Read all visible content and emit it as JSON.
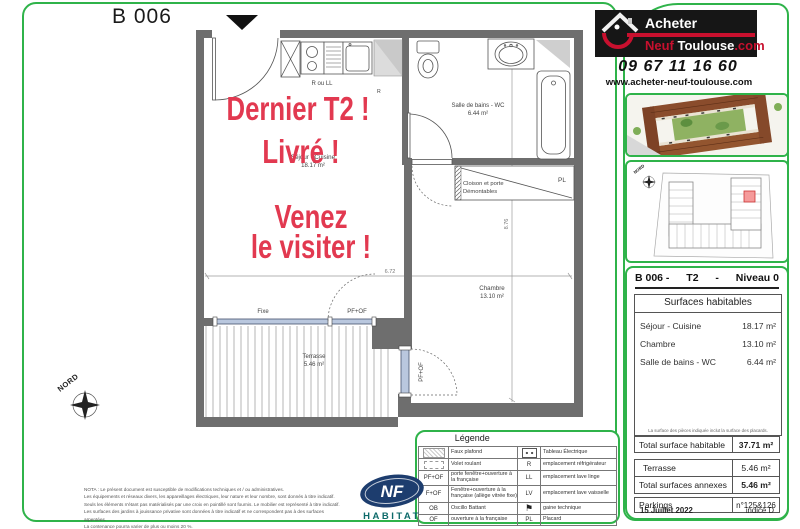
{
  "page": {
    "title": "B 006"
  },
  "plan": {
    "rooms": [
      {
        "name": "Séjour - Cuisine",
        "area": "18.17 m²"
      },
      {
        "name": "Salle de bains - WC",
        "area": "6.44 m²"
      },
      {
        "name": "Chambre",
        "area": "13.10 m²"
      },
      {
        "name": "Terrasse",
        "area": "5.46 m²"
      }
    ],
    "labels": {
      "r_ou_ll": "R ou LL",
      "r": "R",
      "fixe": "Fixe",
      "pf_of": "PF+OF",
      "pl": "PL",
      "cloison1": "Cloison et porte",
      "cloison2": "Démontables",
      "dim_width": "6.72",
      "dim_height": "8.76",
      "nord": "NORD"
    }
  },
  "promo": {
    "line1": "Dernier T2 !",
    "line2": "Livré !",
    "line3": "Venez",
    "line4": "le visiter !"
  },
  "nota": {
    "lines": [
      "NOTA : Le présent document est susceptible de modifications techniques et / ou administratives.",
      "Les équipements et réseaux divers, les appareillages électriques, leur nature et leur nombre, sont donnés à titre indicatif.",
      "Seuls les éléments n'étant pas matérialisés par une croix en pointillé sont fournis. Le mobilier est représenté à titre indicatif.",
      "Les surfaces des jardins à jouissance privative sont données à titre indicatif et ne correspondent pas à des surfaces arpentées.",
      "La contenance pourra varier de plus ou moins 20 %."
    ]
  },
  "certification": {
    "nf": "NF",
    "habitat": "HABITAT"
  },
  "legend": {
    "title": "Légende",
    "rows": [
      {
        "code": "",
        "label": "Faux plafond",
        "code2": "",
        "label2": "Tableau Électrique"
      },
      {
        "code": "",
        "label": "Volet roulant",
        "code2": "R",
        "label2": "emplacement réfrigérateur"
      },
      {
        "code": "PF+OF",
        "label": "porte fenêtre+ouverture à la française",
        "code2": "LL",
        "label2": "emplacement lave linge"
      },
      {
        "code": "F+OF",
        "label": "Fenêtre+ouverture à la française (allège vitrée fixe)",
        "code2": "LV",
        "label2": "emplacement lave vaisselle"
      },
      {
        "code": "OB",
        "label": "Oscillo Battant",
        "code2": "",
        "label2": "gaine technique"
      },
      {
        "code": "OF",
        "label": "ouverture à la française",
        "code2": "PL",
        "label2": "Placard"
      }
    ]
  },
  "agency": {
    "brand_top": "Acheter",
    "brand_neuf": "Neuf ",
    "brand_toulouse": "Toulouse",
    "brand_dotcom": ".com",
    "phone": "09 67 11 16 60",
    "website": "www.acheter-neuf-toulouse.com"
  },
  "info": {
    "unit": "B 006 -",
    "type": "T2",
    "dash": "-",
    "level": "Niveau 0",
    "surfaces_title": "Surfaces habitables",
    "surfaces": [
      {
        "label": "Séjour - Cuisine",
        "value": "18.17 m²"
      },
      {
        "label": "Chambre",
        "value": "13.10 m²"
      },
      {
        "label": "Salle de bains - WC",
        "value": "6.44 m²"
      }
    ],
    "note": "La surface des pièces indiquée inclut la surface des placards.",
    "total_label": "Total surface habitable",
    "total_value": "37.71 m²",
    "terrace_label": "Terrasse",
    "terrace_value": "5.46 m²",
    "annex_label": "Total surfaces annexes",
    "annex_value": "5.46 m²",
    "parking_label": "Parkings",
    "parking_value": "n°125&126",
    "date": "15 Juillet 2022",
    "indice": "indice D"
  },
  "colors": {
    "accent_green": "#2fb34a",
    "promo_red": "#e23950",
    "logo_red": "#c8102e",
    "unit_highlight": "#f59a9a"
  }
}
